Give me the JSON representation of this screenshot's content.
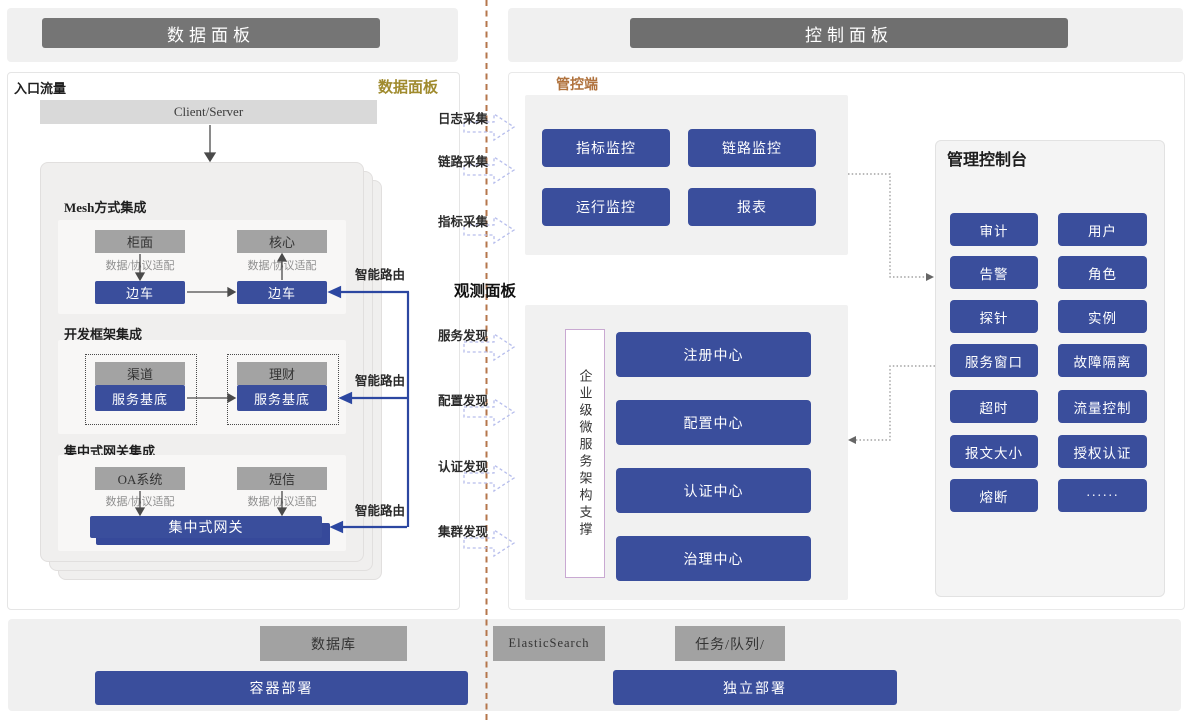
{
  "header": {
    "left_title": "数据面板",
    "right_title": "控制面板"
  },
  "data_panel": {
    "corner_label": "入口流量",
    "panel_label": "数据面板",
    "client_server": "Client/Server",
    "adapter_label": "数据/协议适配",
    "smart_route_label": "智能路由",
    "mesh": {
      "title": "Mesh方式集成",
      "left_top": "柜面",
      "right_top": "核心",
      "left_bottom": "边车",
      "right_bottom": "边车"
    },
    "framework": {
      "title": "开发框架集成",
      "left_top": "渠道",
      "right_top": "理财",
      "left_bottom": "服务基底",
      "right_bottom": "服务基底"
    },
    "gateway": {
      "title": "集中式网关集成",
      "left_top": "OA系统",
      "right_top": "短信",
      "bar": "集中式网关"
    }
  },
  "flow": {
    "collect": [
      "日志采集",
      "链路采集",
      "指标采集"
    ],
    "observe_title": "观测面板",
    "discover": [
      "服务发现",
      "配置发现",
      "认证发现",
      "集群发现"
    ]
  },
  "control_panel": {
    "label": "管控端",
    "monitors": [
      "指标监控",
      "链路监控",
      "运行监控",
      "报表"
    ],
    "support_box": "企业级微服务架构支撑",
    "centers": [
      "注册中心",
      "配置中心",
      "认证中心",
      "治理中心"
    ],
    "console": {
      "title": "管理控制台",
      "buttons": [
        "审计",
        "用户",
        "告警",
        "角色",
        "探针",
        "实例",
        "服务窗口",
        "故障隔离",
        "超时",
        "流量控制",
        "报文大小",
        "授权认证",
        "熔断",
        "······"
      ]
    }
  },
  "footer": {
    "database": "数据库",
    "elasticsearch": "ElasticSearch",
    "queue": "任务/队列/",
    "container_deploy": "容器部署",
    "standalone_deploy": "独立部署"
  },
  "colors": {
    "accent_blue": "#3a4e9c",
    "header_gray": "#757575",
    "node_gray": "#a3a3a3",
    "divider_brown": "#b5764b",
    "gold_label": "#a08b2e",
    "orange_label": "#b0723d",
    "dashed_arrow": "#b6bdec"
  }
}
